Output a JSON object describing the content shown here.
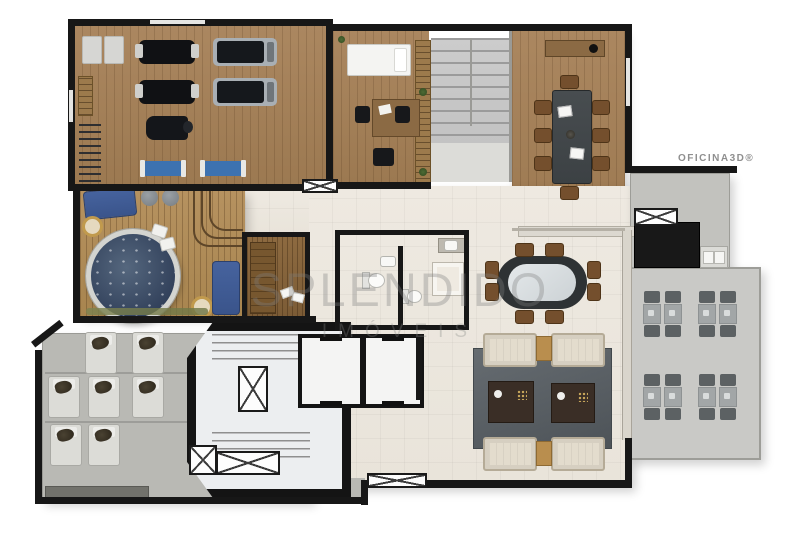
{
  "watermark": {
    "title": "SPLENDIDO",
    "subtitle": "IMÓVEIS"
  },
  "branding": {
    "label": "OFICINA3D®"
  },
  "palette": {
    "wall": "#171717",
    "gym_wood": "#a5815a",
    "deck_wood": "#b28e5e",
    "tile_floor": "#ede9e0",
    "terrace_gray": "#b9b9b4",
    "patio_gray": "#c9c9c6",
    "hot_tub_water": "#3a4c65",
    "lounger_blue": "#3d72b0",
    "sofa_beige": "#d6cfc1",
    "rug_gray": "#575d62",
    "meeting_table": "#43484b",
    "chair_brown": "#744f2d",
    "watermark_gray": "#7d7d7d"
  }
}
